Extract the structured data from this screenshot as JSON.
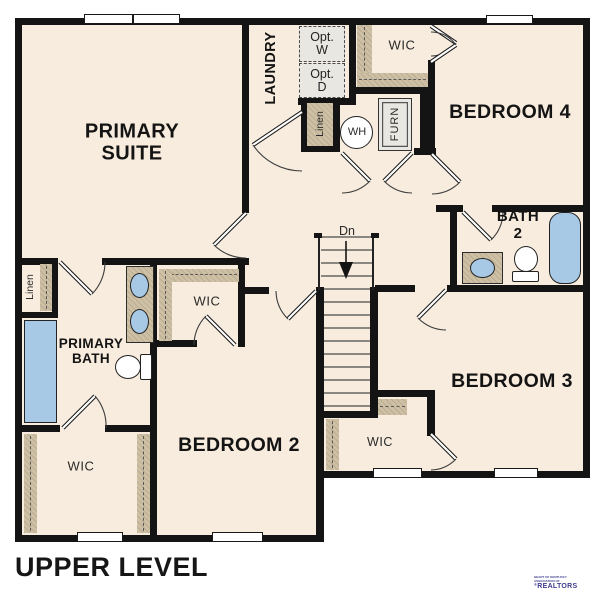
{
  "title": "UPPER LEVEL",
  "rooms": {
    "primary_suite": {
      "line1": "PRIMARY",
      "line2": "SUITE"
    },
    "laundry": "LAUNDRY",
    "bedroom2": "BEDROOM 2",
    "bedroom3": "BEDROOM 3",
    "bedroom4": "BEDROOM 4",
    "bath2": {
      "line1": "BATH",
      "line2": "2"
    },
    "primary_bath": {
      "line1": "PRIMARY",
      "line2": "BATH"
    },
    "wic": "WIC",
    "linen": "Linen"
  },
  "fixtures": {
    "washer": {
      "line1": "Opt.",
      "line2": "W"
    },
    "dryer": {
      "line1": "Opt.",
      "line2": "D"
    },
    "water_heater": "WH",
    "furnace": "FURN"
  },
  "stairs": {
    "direction_label": "Dn"
  },
  "logo": {
    "monogram": "KY",
    "org_line1": "HEART OF KENTUCKY",
    "org_line2": "ASSOCIATION OF",
    "realtors": "REALTORS",
    "registered": "®"
  },
  "colors": {
    "floor": "#f7ecdd",
    "wall": "#141414",
    "casework": "#cec0a5",
    "fixture_blue": "#a7c9e6",
    "appliance_gray": "#e9e7e2",
    "logo_navy": "#3e3c8e",
    "text": "#1b1b1b"
  }
}
